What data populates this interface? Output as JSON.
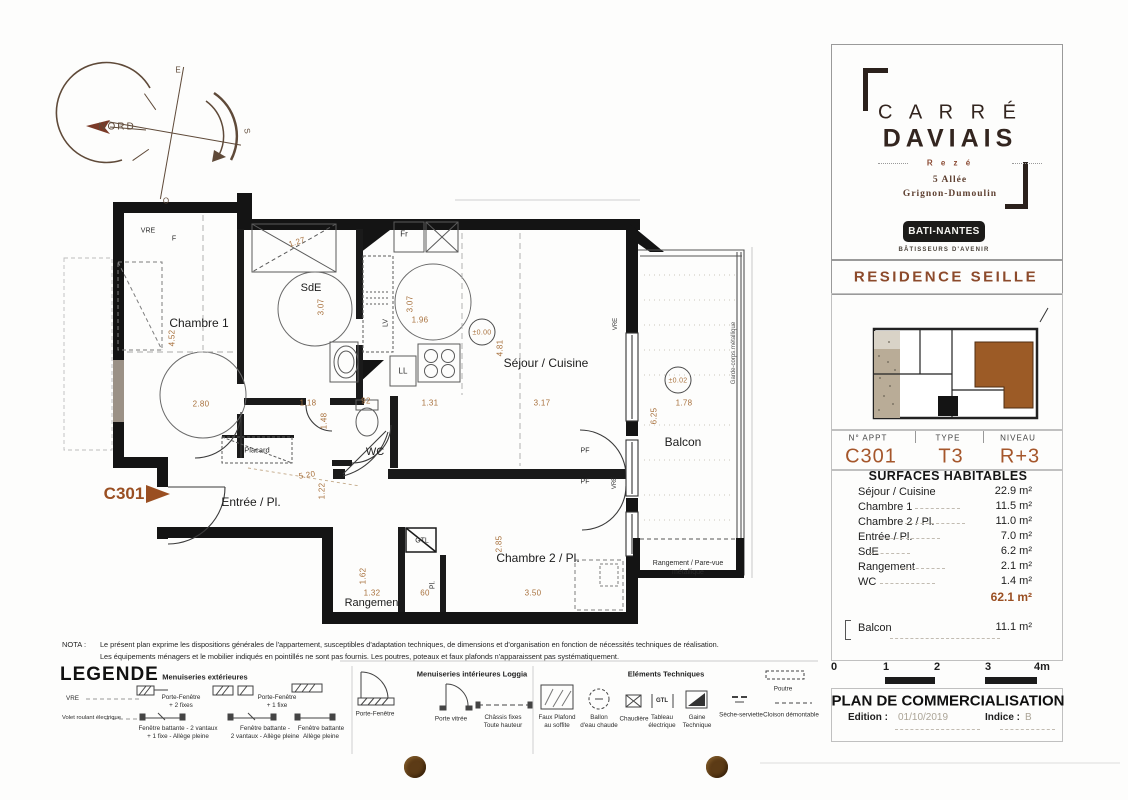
{
  "branding": {
    "logo_line1": "C A R R É",
    "logo_line2": "DAVIAIS",
    "logo_city": "R e z é",
    "logo_address1": "5 Allée",
    "logo_address2": "Grignon-Dumoulin",
    "builder": "BATI-NANTES",
    "builder_tagline": "BÂTISSEURS D'AVENIR",
    "residence": "RESIDENCE SEILLE"
  },
  "apartment": {
    "headers": {
      "appt": "N° APPT",
      "type": "TYPE",
      "level": "NIVEAU"
    },
    "values": {
      "appt": "C301",
      "type": "T3",
      "level": "R+3"
    }
  },
  "surfaces": {
    "title": "SURFACES HABITABLES",
    "rows": [
      {
        "label": "Séjour / Cuisine",
        "value": "22.9 m²"
      },
      {
        "label": "Chambre 1",
        "value": "11.5 m²"
      },
      {
        "label": "Chambre 2 / Pl.",
        "value": "11.0 m²"
      },
      {
        "label": "Entrée / Pl.",
        "value": "7.0 m²"
      },
      {
        "label": "SdE",
        "value": "6.2 m²"
      },
      {
        "label": "Rangement",
        "value": "2.1 m²"
      },
      {
        "label": "WC",
        "value": "1.4 m²"
      }
    ],
    "total": "62.1 m²",
    "balcony": {
      "label": "Balcon",
      "value": "11.1 m²"
    }
  },
  "scalebar": {
    "t0": "0",
    "t1": "1",
    "t2": "2",
    "t3": "3",
    "t4": "4m"
  },
  "title_block": {
    "title": "PLAN DE COMMERCIALISATION",
    "edition_label": "Edition :",
    "edition_value": "01/10/2019",
    "indice_label": "Indice :",
    "indice_value": "B"
  },
  "nota": {
    "label": "NOTA :",
    "line1": "Le présent plan exprime les dispositions générales de l'appartement, susceptibles d'adaptation techniques, de dimensions et d'organisation en fonction de nécessités techniques de réalisation.",
    "line2": "Les équipements ménagers et le mobilier indiqués en pointillés ne sont pas fournis. Les poutres, poteaux et faux plafonds n'apparaissent pas systématiquement."
  },
  "legend": {
    "title": "LEGENDE",
    "ext": {
      "header": "Menuiseries extérieures",
      "vre": "VRE",
      "vre_desc": "Volet roulant électrique",
      "pf2fixes": "Porte-Fenêtre\n+ 2 fixes",
      "pf1fixe": "Porte-Fenêtre\n+ 1 fixe",
      "fb1": "Fenêtre battante - 2 vantaux\n+ 1 fixe - Allège pleine",
      "fb2": "Fenêtre battante -\n2 vantaux - Allège pleine",
      "fb3": "Fenêtre battante\nAllège pleine"
    },
    "int": {
      "header": "Menuiseries intérieures Loggia",
      "pf": "Porte-Fenêtre",
      "pv": "Porte vitrée",
      "chassis": "Châssis fixes\nToute hauteur"
    },
    "tech": {
      "header": "Eléments Techniques",
      "faux_plafond": "Faux Plafond\nau soffite",
      "ballon": "Ballon\nd'eau chaude",
      "chaudiere": "Chaudière",
      "tableau": "Tableau\nélectrique",
      "gtl": "GTL",
      "gaine": "Gaine\nTechnique",
      "seche": "Sèche-serviette",
      "cloison": "Cloison démontable",
      "poutre": "Poutre"
    }
  },
  "plan": {
    "compass": {
      "nord": "NORD",
      "east": "E",
      "south": "S",
      "west": "O"
    },
    "unit_marker": "C301",
    "rooms": {
      "chambre1": "Chambre 1",
      "sde": "SdE",
      "wc": "WC",
      "entree": "Entrée / Pl.",
      "rangement": "Rangement",
      "chambre2": "Chambre 2 / Pl.",
      "sejour": "Séjour / Cuisine",
      "balcon": "Balcon",
      "placard": "Placard"
    },
    "tags": {
      "vre": "VRE",
      "f": "F",
      "fr": "Fr",
      "lv": "LV",
      "ll": "LL",
      "gtl": "GTL",
      "pl": "Pl.",
      "pf": "PF",
      "garde_corps": "Garde-corps métallique",
      "pare_vue": "Rangement / Pare-vue\nmétallique"
    },
    "levels": {
      "l0": "±0.00",
      "l1": "±0.02"
    },
    "dims": {
      "c1_h": "4.52",
      "c1_w": "2.80",
      "shower": "1.27",
      "sde_h": "3.07",
      "kit_h": "3.07",
      "kit_w": "1.96",
      "sde_w": "1.18",
      "wc_h": "1.48",
      "wc_w": "92",
      "kit_b": "1.31",
      "sej_h": "4.81",
      "sej_w": "3.17",
      "bal_h": "6.25",
      "bal_w": "1.78",
      "ent_d": "5.20",
      "ent_h": "1.22",
      "rang_h": "1.62",
      "rang_w": "1.32",
      "pl_w": "60",
      "c2_h": "2.85",
      "c2_w": "3.50"
    }
  },
  "colors": {
    "accent": "#9a4f22",
    "wall": "#141414",
    "dim_text": "#a8713d",
    "keymap_highlight": "#9c5b26",
    "hole_punch": "#5c3b16"
  }
}
